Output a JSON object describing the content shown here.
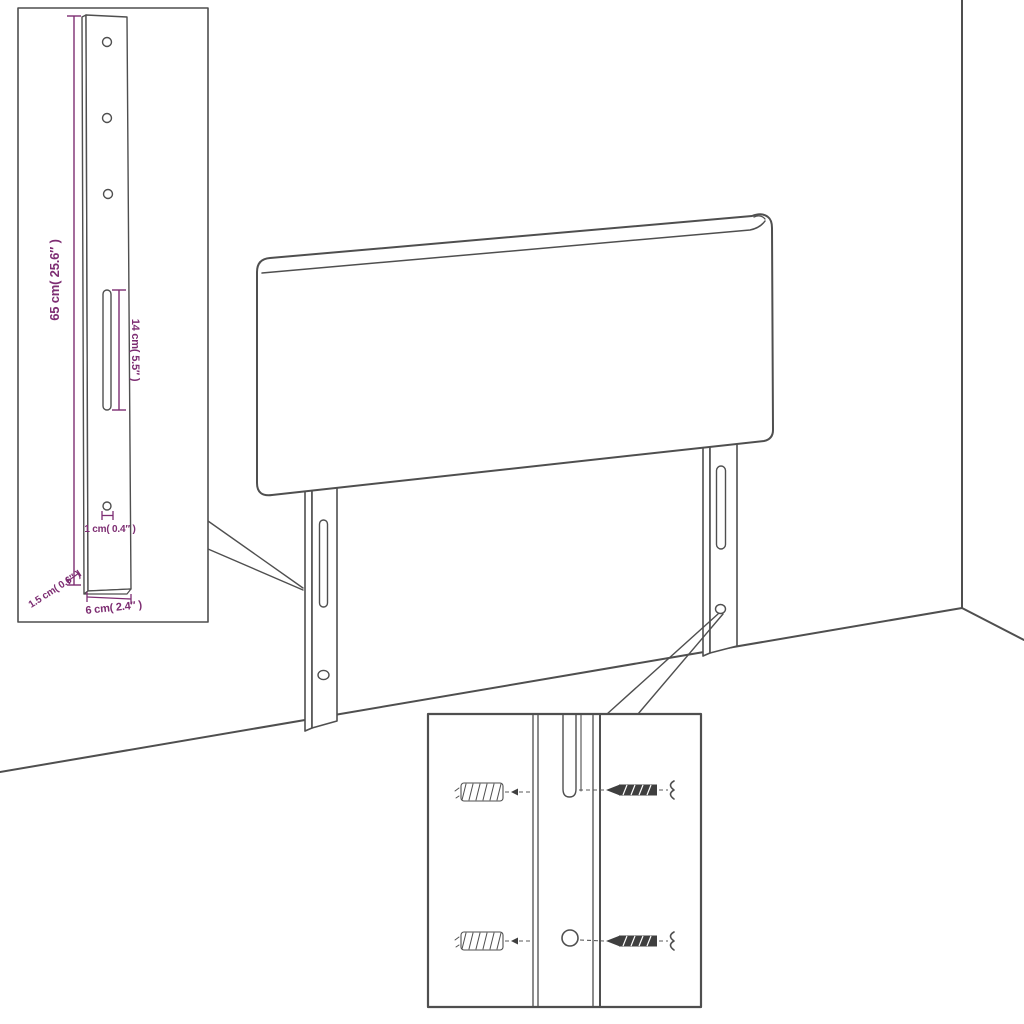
{
  "colors": {
    "line": "#4f4f4f",
    "dimension": "#7d2d72",
    "background": "#ffffff"
  },
  "dims": {
    "height": "65 cm( 25.6″ )",
    "slot": "14 cm( 5.5″ )",
    "hole": "1 cm( 0.4″ )",
    "depth": "1.5 cm( 0.6″ )",
    "width": "6 cm( 2.4″ )"
  },
  "parts": {
    "headboard": "headboard-panel",
    "leg": "mounting-leg",
    "wall_plug": "wall-plug",
    "screw": "screw"
  }
}
